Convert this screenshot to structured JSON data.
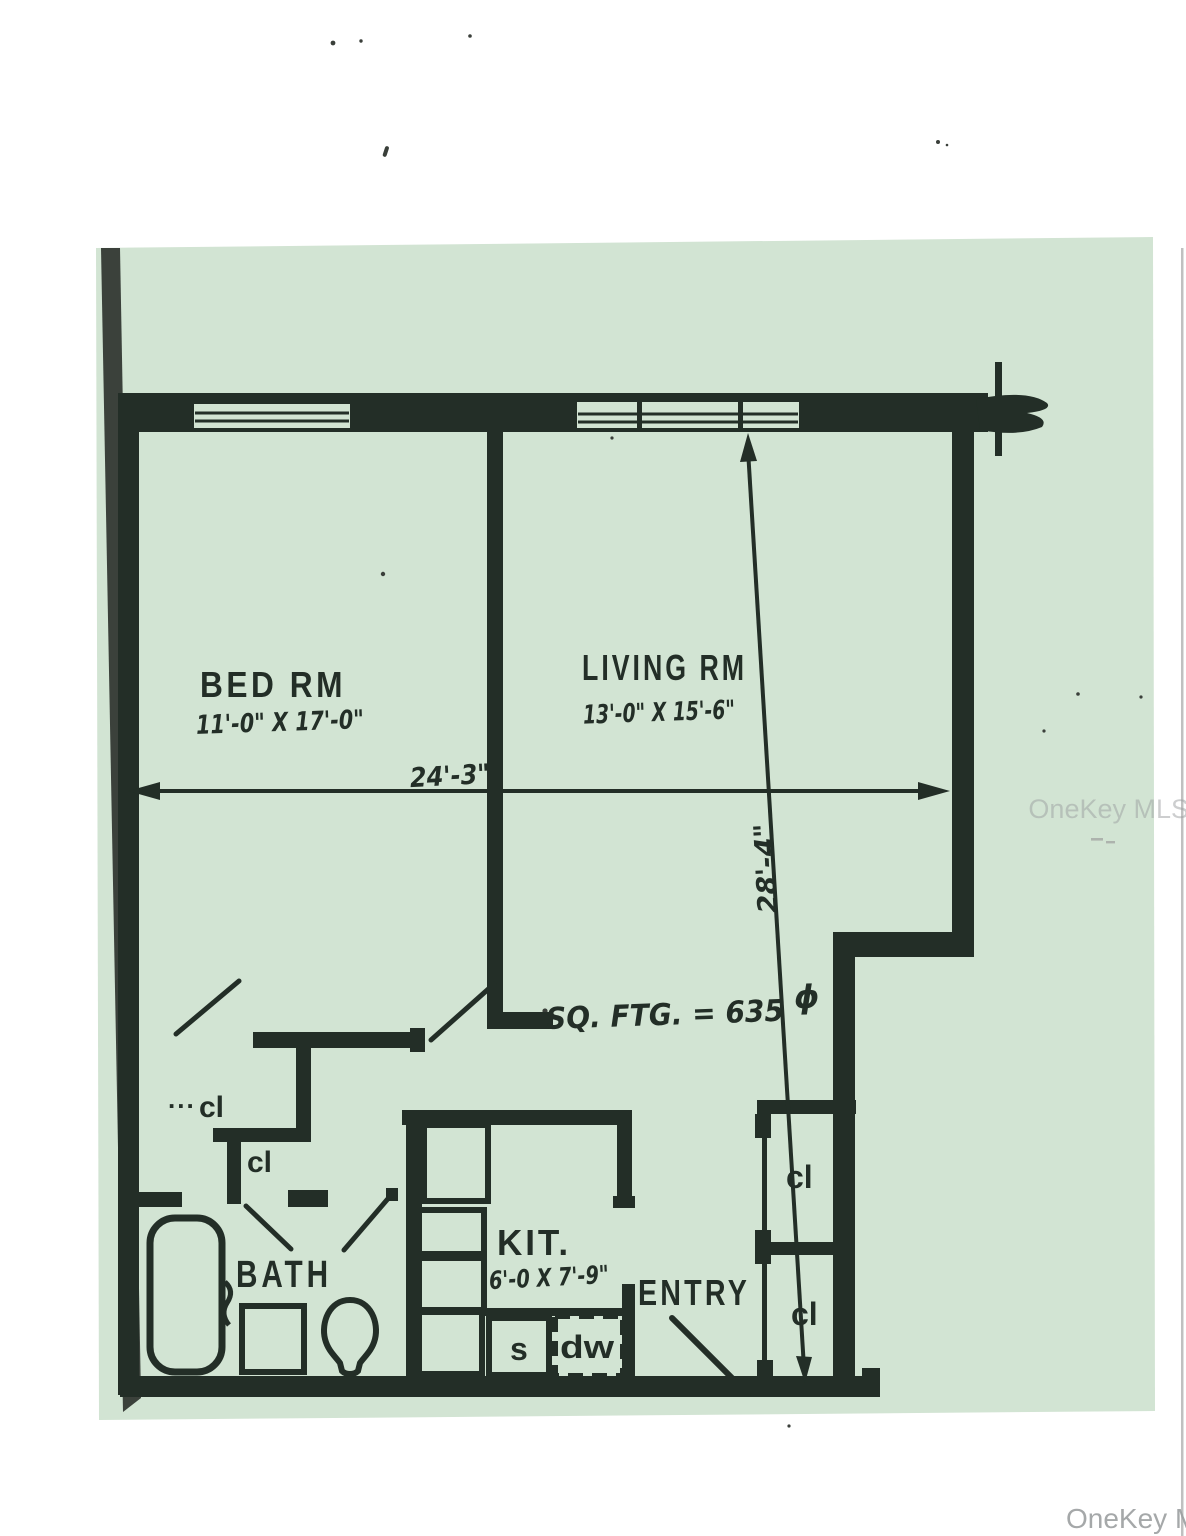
{
  "page": {
    "bg_color": "#d2e4d3",
    "ink_color": "#232e27",
    "watermark": {
      "text": "OneKey MLS",
      "color": "#9c9fa0"
    }
  },
  "floor_plan": {
    "rooms": {
      "bedroom": {
        "label": "BED RM",
        "size": "11'-0\" X 17'-0\""
      },
      "living_room": {
        "label": "LIVING RM",
        "size": "13'-0\" X 15'-6\""
      },
      "bathroom": {
        "label": "BATH"
      },
      "kitchen": {
        "label": "KIT.",
        "size": "6'-0 X 7'-9\""
      },
      "entry": {
        "label": "ENTRY"
      }
    },
    "fixtures": {
      "sink": "s",
      "dishwasher": "dw"
    },
    "closets": {
      "c1": "cl",
      "c2": "cl",
      "c3": "cl",
      "c4": "cl",
      "c1_dashes": "..."
    },
    "dimensions": {
      "overall_width": "24'-3\"",
      "overall_height": "28'-4\"",
      "square_footage": "SQ. FTG. = 635",
      "square_footage_mark": "ϕ"
    }
  }
}
